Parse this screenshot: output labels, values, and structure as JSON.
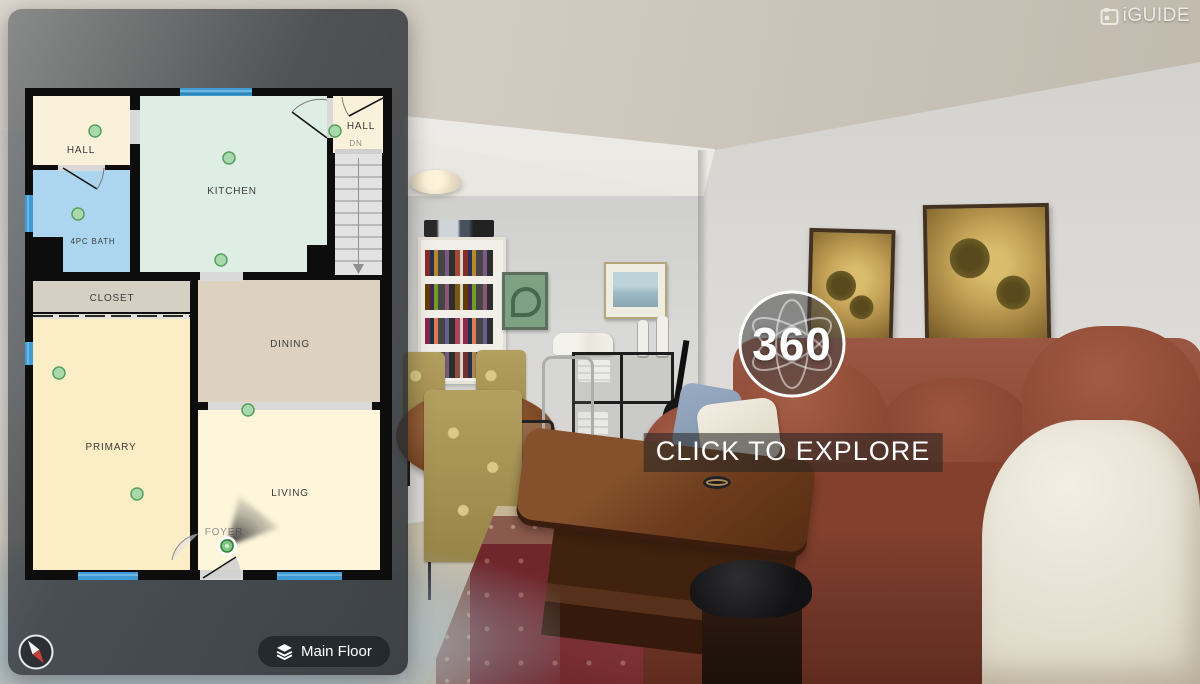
{
  "brand": {
    "name": "iGUIDE"
  },
  "viewer": {
    "badge_label": "360",
    "caption": "CLICK TO EXPLORE"
  },
  "toolbar": {
    "floor_label": "Main Floor"
  },
  "floorplan": {
    "floor_name": "Main Floor",
    "rooms": {
      "hall_upper_left": "HALL",
      "bath": "4PC BATH",
      "kitchen": "KITCHEN",
      "hall_stairs": "HALL",
      "stairs_direction": "DN",
      "closet": "CLOSET",
      "dining": "DINING",
      "primary": "PRIMARY",
      "living": "LIVING",
      "foyer": "FOYER"
    },
    "panorama_point_count": "9",
    "colors": {
      "wall": "#0d0d0d",
      "window": "#3e9bd3",
      "door_opening": "#d9d9d9",
      "marker_fill": "#a9d8ad",
      "marker_stroke": "#55a05d",
      "room_hall": "#f9f1d9",
      "room_bath": "#acd6f0",
      "room_kitchen": "#dfeee4",
      "room_closet": "#d6cfc4",
      "room_dining": "#ddd2c2",
      "room_primary": "#fbeec6",
      "room_living": "#fdf6da",
      "panel_bg": "rgba(38,42,46,0.84)"
    }
  }
}
